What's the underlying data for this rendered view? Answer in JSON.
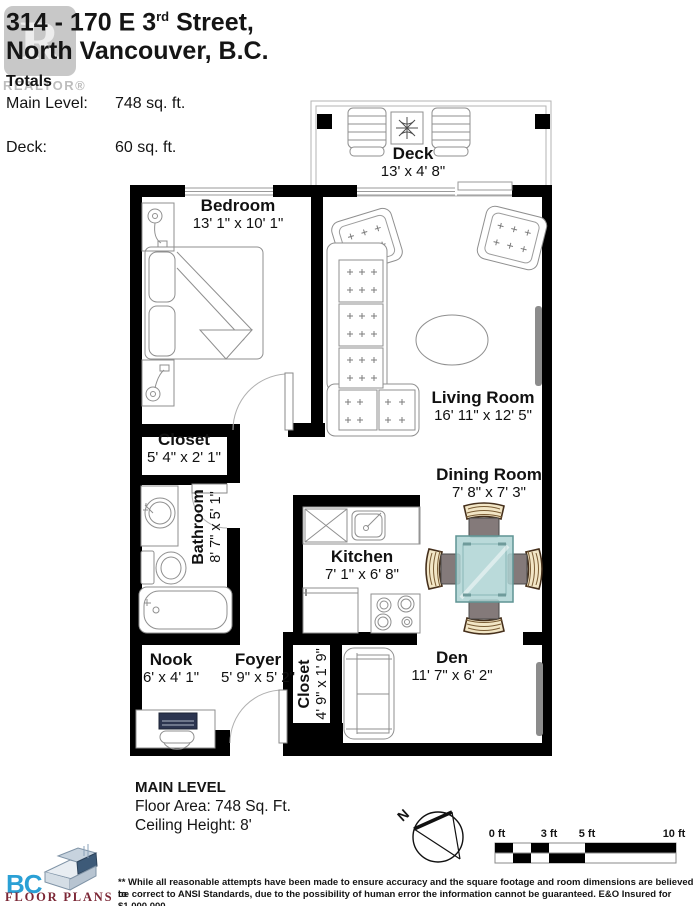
{
  "header": {
    "title_prefix": "314 - 170 E 3",
    "title_sup": "rd",
    "title_suffix": " Street,",
    "title_line2": "North Vancouver, B.C.",
    "watermark": {
      "letter": "R",
      "label": "REALTOR®"
    },
    "totals": {
      "heading": "Totals",
      "rows": [
        {
          "label": "Main Level:",
          "value": "748 sq. ft."
        },
        {
          "label": "Deck:",
          "value": "60 sq. ft."
        }
      ]
    }
  },
  "rooms": [
    {
      "id": "deck",
      "name": "Deck",
      "dims": "13' x 4' 8\""
    },
    {
      "id": "bedroom",
      "name": "Bedroom",
      "dims": "13' 1\" x 10' 1\""
    },
    {
      "id": "living",
      "name": "Living Room",
      "dims": "16' 11\" x 12' 5\""
    },
    {
      "id": "closet1",
      "name": "Closet",
      "dims": "5' 4\" x 2' 1\""
    },
    {
      "id": "bathroom",
      "name": "Bathroom",
      "dims": "8' 7\" x 5' 1\""
    },
    {
      "id": "kitchen",
      "name": "Kitchen",
      "dims": "7' 1\" x 6' 8\""
    },
    {
      "id": "dining",
      "name": "Dining Room",
      "dims": "7' 8\" x 7' 3\""
    },
    {
      "id": "nook",
      "name": "Nook",
      "dims": "6' x 4' 1\""
    },
    {
      "id": "foyer",
      "name": "Foyer",
      "dims": "5' 9\" x 5' 2\""
    },
    {
      "id": "closet2",
      "name": "Closet",
      "dims": "4' 9\" x 1' 9\""
    },
    {
      "id": "den",
      "name": "Den",
      "dims": "11' 7\" x 6' 2\""
    }
  ],
  "footer": {
    "level_title": "MAIN LEVEL",
    "floor_area": "Floor Area: 748 Sq. Ft.",
    "ceiling_height": "Ceiling Height: 8'",
    "compass_label": "N",
    "scale_bar": {
      "labels": [
        "0 ft",
        "3 ft",
        "5 ft",
        "10 ft"
      ]
    },
    "logo": {
      "bc": "BC",
      "floor_plans": "FLOOR PLANS"
    },
    "disclaimer_line1": "** While all reasonable attempts have been made to ensure accuracy and the square footage and room dimensions are believed to",
    "disclaimer_line2": "be correct to ANSI Standards, due to the possibility of human error the information cannot be guaranteed. E&O Insured for $1,000,000"
  },
  "colors": {
    "wall": "#000000",
    "dining_table": "#aed4d4",
    "chair_wood": "#f2e6c6",
    "tv_gray": "#8c8c8c",
    "logo_blue": "#2aa0d5",
    "logo_red": "#7c2736",
    "watermark_gray": "#c8c8c8"
  }
}
